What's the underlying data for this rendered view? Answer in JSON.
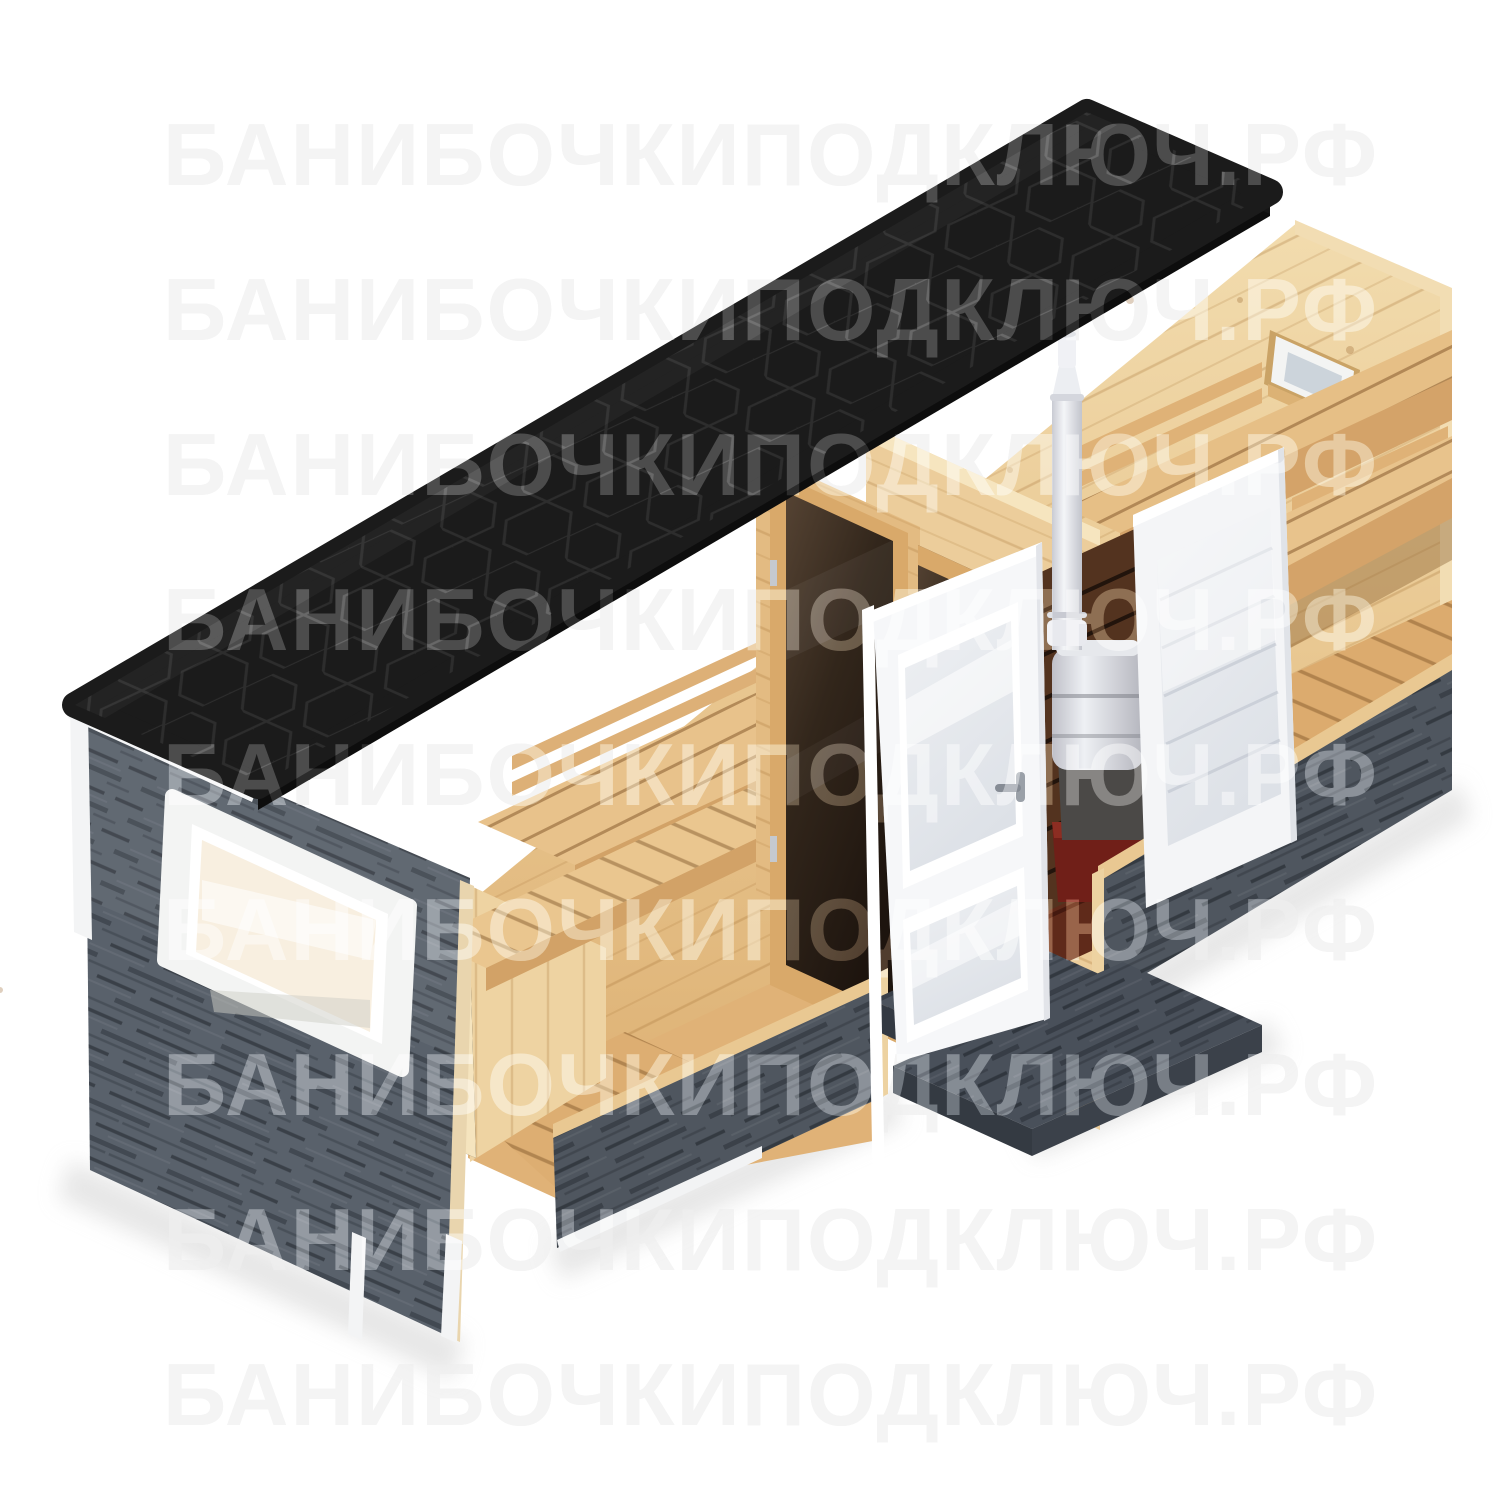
{
  "watermark": {
    "text": "БАНИБОЧКИПОДКЛЮЧ.РФ",
    "rows": 9,
    "color": "#eaeaea"
  },
  "scene": {
    "type": "isometric-3d-product-render",
    "subject": "Mobile rectangular banya (sauna cabin) shown in cutaway view",
    "parts": [
      {
        "id": "roof",
        "label": "Black hexagonal shingle roof"
      },
      {
        "id": "end-wall",
        "label": "Gray weathered wood end wall"
      },
      {
        "id": "end-wall-window",
        "label": "White framed window"
      },
      {
        "id": "front-base-band",
        "label": "Gray front base band"
      },
      {
        "id": "rest-room",
        "label": "Rest room with slatted benches"
      },
      {
        "id": "tinted-door",
        "label": "Bronze tinted glass door"
      },
      {
        "id": "steam-room",
        "label": "Steam room with two-tier benches"
      },
      {
        "id": "steam-window",
        "label": "Small sauna window"
      },
      {
        "id": "stove",
        "label": "Sauna stove with red base"
      },
      {
        "id": "chimney",
        "label": "Stainless chimney pipe"
      },
      {
        "id": "entry-door",
        "label": "White entry door with two glass panes"
      },
      {
        "id": "steam-door",
        "label": "White frosted glass door"
      },
      {
        "id": "ramp",
        "label": "Gray entrance step and ramp"
      }
    ]
  },
  "palette": {
    "background": "#ffffff",
    "watermark_gray": "#eaeaea",
    "roof_black": "#1b1b1b",
    "roof_hex_line": "#2d2d2d",
    "gray_wall": "#59616b",
    "gray_wall_dark": "#3f454d",
    "ramp_gray": "#49505a",
    "wood_light": "#eccd9b",
    "wood_mid": "#dfae6f",
    "wood_dark": "#c2914f",
    "tinted_glass": "#32261b",
    "white_trim": "#f5f6f7",
    "frosted_glass": "#e6e9ee",
    "stove_metal": "#d9dadf",
    "stove_red": "#701f18",
    "shield_brown": "#53331f"
  }
}
